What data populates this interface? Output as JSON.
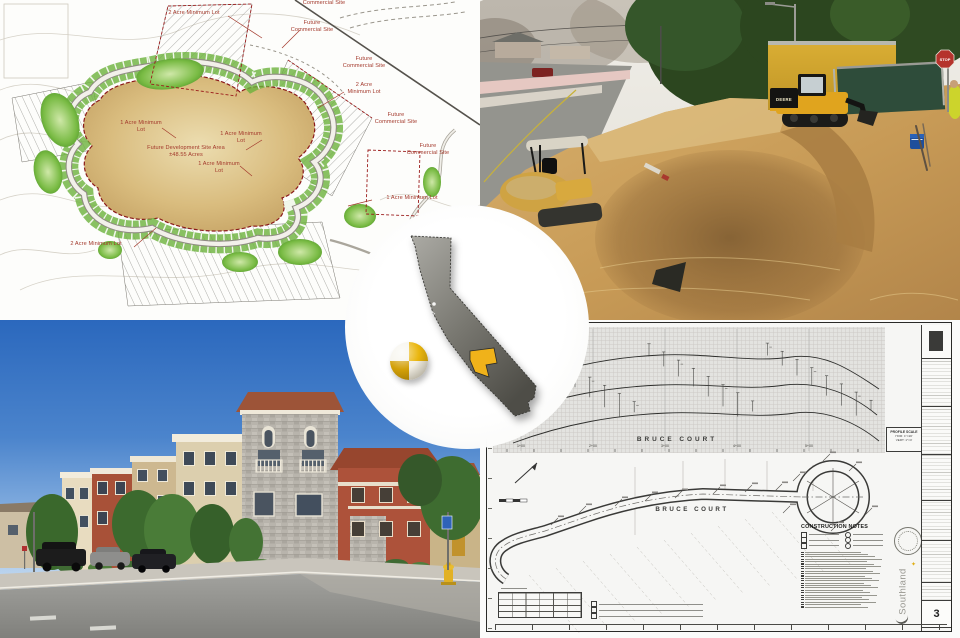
{
  "site_plan": {
    "labels": [
      {
        "text": "2 Acre Minimum Lot",
        "x": 158,
        "y": 10,
        "w": 72
      },
      {
        "text": "Future Commercial Site",
        "x": 300,
        "y": -7,
        "w": 48
      },
      {
        "text": "Future Commercial Site",
        "x": 288,
        "y": 20,
        "w": 48
      },
      {
        "text": "Future Commercial Site",
        "x": 340,
        "y": 56,
        "w": 48
      },
      {
        "text": "2 Acre Minimum Lot",
        "x": 344,
        "y": 82,
        "w": 40
      },
      {
        "text": "Future Commercial Site",
        "x": 372,
        "y": 112,
        "w": 48
      },
      {
        "text": "Future Commercial Site",
        "x": 404,
        "y": 143,
        "w": 48
      },
      {
        "text": "1 Acre Minimum Lot",
        "x": 120,
        "y": 120,
        "w": 42
      },
      {
        "text": "1 Acre Minimum Lot",
        "x": 220,
        "y": 131,
        "w": 42
      },
      {
        "text": "Future Development Site Area ±48.55 Acres",
        "x": 140,
        "y": 145,
        "w": 92
      },
      {
        "text": "1 Acre Minimum Lot",
        "x": 198,
        "y": 161,
        "w": 42
      },
      {
        "text": "1 Acre Minimum Lot",
        "x": 372,
        "y": 195,
        "w": 80
      },
      {
        "text": "2 Acre Minimum Lot",
        "x": 56,
        "y": 241,
        "w": 80
      }
    ]
  },
  "construction_photo": {
    "loader_brand": "DEERE",
    "stop_sign_text": "STOP"
  },
  "locator": {
    "state_icon": "california-map-icon",
    "marker_icon": "survey-target-icon",
    "highlight_color": "#f0b21a"
  },
  "sheet": {
    "profile_street_label": "BRUCE COURT",
    "plan_street_label": "BRUCE COURT",
    "profile_scale_title": "PROFILE SCALE",
    "profile_scale_hor": "HOR: 1\"=20'",
    "profile_scale_vert": "VERT: 1\"=4'",
    "notes_title": "CONSTRUCTION NOTES",
    "company_logo": "Southland",
    "company_star_icon": "✦",
    "sheet_number": "3",
    "stations": [
      {
        "text": "1+00",
        "x": 34
      },
      {
        "text": "2+00",
        "x": 106
      },
      {
        "text": "3+00",
        "x": 178
      },
      {
        "text": "4+00",
        "x": 250
      },
      {
        "text": "5+00",
        "x": 322
      }
    ]
  },
  "colors": {
    "deere_yellow": "#e0a41e",
    "plan_green": "#6cb13c",
    "development_tan": "#cfa763",
    "county_highlight": "#f0b21a",
    "stop_red": "#b5332c",
    "sky_blue": "#2f6fc3",
    "label_red": "#a3392c"
  }
}
